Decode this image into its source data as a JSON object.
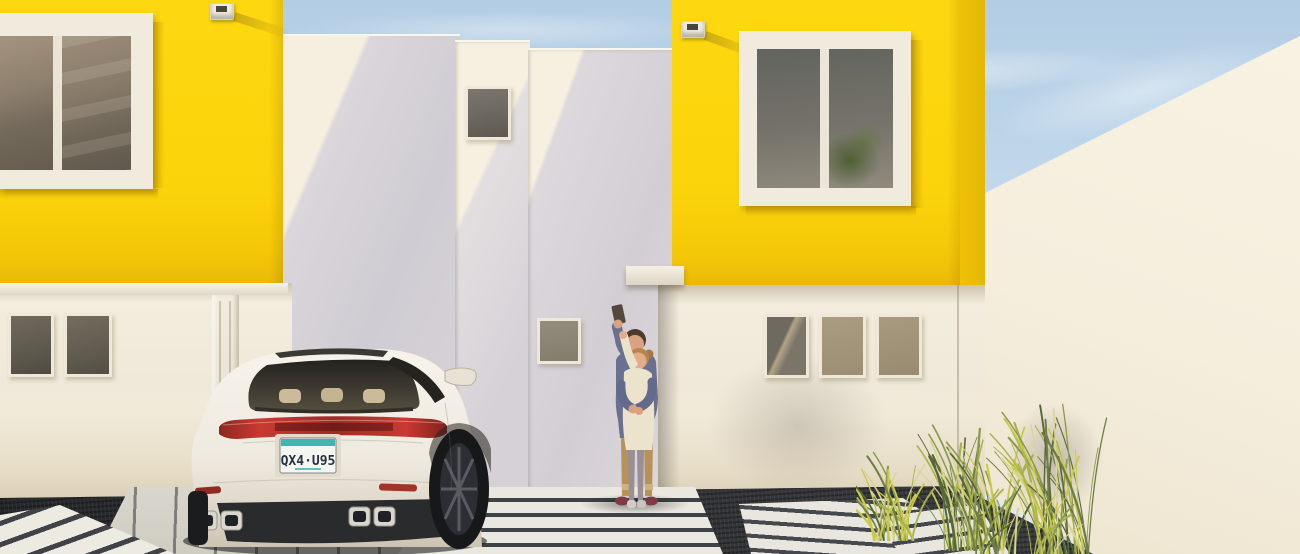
{
  "scene": {
    "type": "architectural-exterior-render",
    "elements": [
      "sky",
      "yellow-house-left",
      "yellow-house-right",
      "white-entry-volumes",
      "white-boundary-wall",
      "white-suv-rear",
      "couple-taking-selfie",
      "ornamental-grasses",
      "gravel-yard",
      "paver-walkways",
      "wall-lamps"
    ]
  },
  "license_plate": {
    "text": "QX4·U95",
    "band_color": "#3fb6b2",
    "plate_color": "#f4f6f2",
    "text_color": "#27313f"
  },
  "palette": {
    "facade-yellow": "#fbd30b",
    "facade-yellow-shade": "#e3b806",
    "wall-cream": "#f6efdf",
    "wall-shadow": "#d5d1d7",
    "ground-wall": "#f1ead9",
    "boundary-wall": "#f8f2e3",
    "sky-top": "#b3cde4",
    "sky-horizon": "#dfe8ef",
    "gravel": "#2e3033",
    "paver": "#e9e7df",
    "paver-gap": "#3e4145",
    "car-body": "#f2eee5",
    "tail-light": "#b5332c",
    "glass-dark": "#55503f",
    "grass-green": "#8a9a50",
    "grass-yellow": "#c9ca49"
  },
  "grass_colors": [
    "#55663c",
    "#6f7d44",
    "#8a9a50",
    "#a9b24d",
    "#c9ca49",
    "#d8d593"
  ]
}
